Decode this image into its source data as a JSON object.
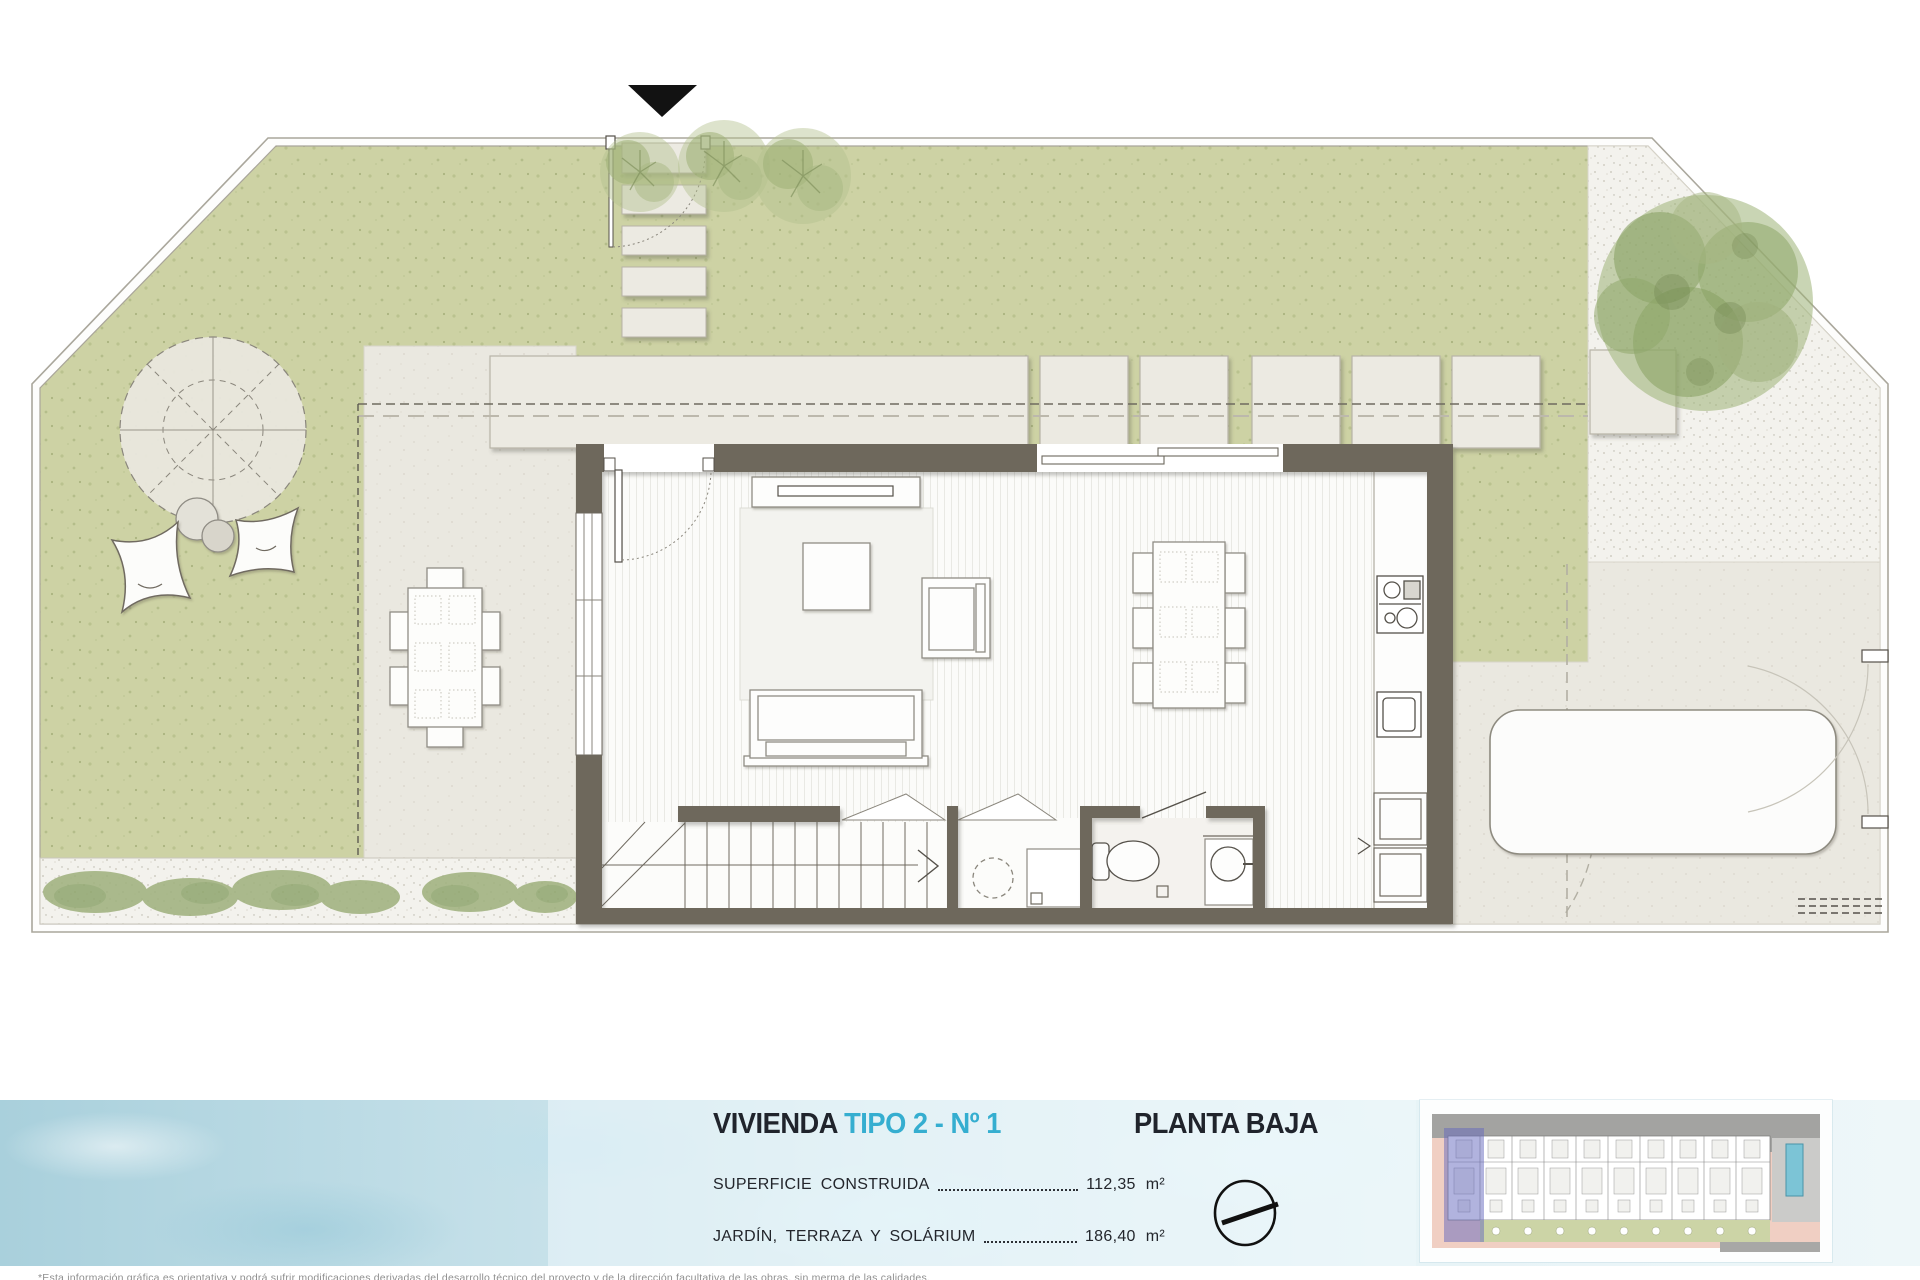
{
  "title_block": {
    "project_label": "VIVIENDA",
    "unit_label": "TIPO 2 - Nº 1",
    "floor_label": "PLANTA BAJA",
    "areas": [
      {
        "label": "SUPERFICIE  CONSTRUIDA",
        "value": "112,35",
        "unit": "m²"
      },
      {
        "label": "JARDÍN,  TERRAZA  Y  SOLÁRIUM",
        "value": "186,40",
        "unit": "m²"
      }
    ],
    "compass_icon": "north-compass-icon"
  },
  "footnote": {
    "text": "*Esta información gráfica es orientativa y podrá sufrir modificaciones derivadas del desarrollo técnico del proyecto y de la dirección facultativa de las obras, sin merma de las calidades."
  },
  "plan": {
    "entry_marker_icon": "entry-arrow-icon",
    "elements": [
      "plot-boundary",
      "lawn",
      "gravel-corner",
      "gravel-shrub-strip",
      "left-terrace",
      "driveway",
      "paver-slabs",
      "stepping-stones",
      "entry-gate",
      "pergola",
      "bean-bag-cushions",
      "poufs",
      "outdoor-dining-set",
      "trees",
      "shrubs",
      "car",
      "side-gates",
      "house",
      "entry-door",
      "sliding-door",
      "left-window",
      "living-room-rug",
      "tv-console",
      "coffee-table",
      "armchair",
      "sofa",
      "dining-table-set",
      "kitchen-counter",
      "cooktop",
      "kitchen-sink",
      "kitchen-cabinets",
      "staircase",
      "utility-room",
      "washing-machine",
      "bathroom",
      "toilet",
      "washbasin",
      "overhang-dashed-lines",
      "site-thumbnail"
    ]
  },
  "colors": {
    "accent_cyan": "#35aed0",
    "heading_dark": "#20242c",
    "wall_dark": "#6e675c",
    "lawn_green": "#cdd2a4",
    "terrace_beige": "#eae8e0",
    "gravel_light": "#f3f2ed",
    "water_blue": "#c3dfe8",
    "thumbnail_highlight": "#6468be",
    "pool_blue": "#7cc4d6"
  }
}
